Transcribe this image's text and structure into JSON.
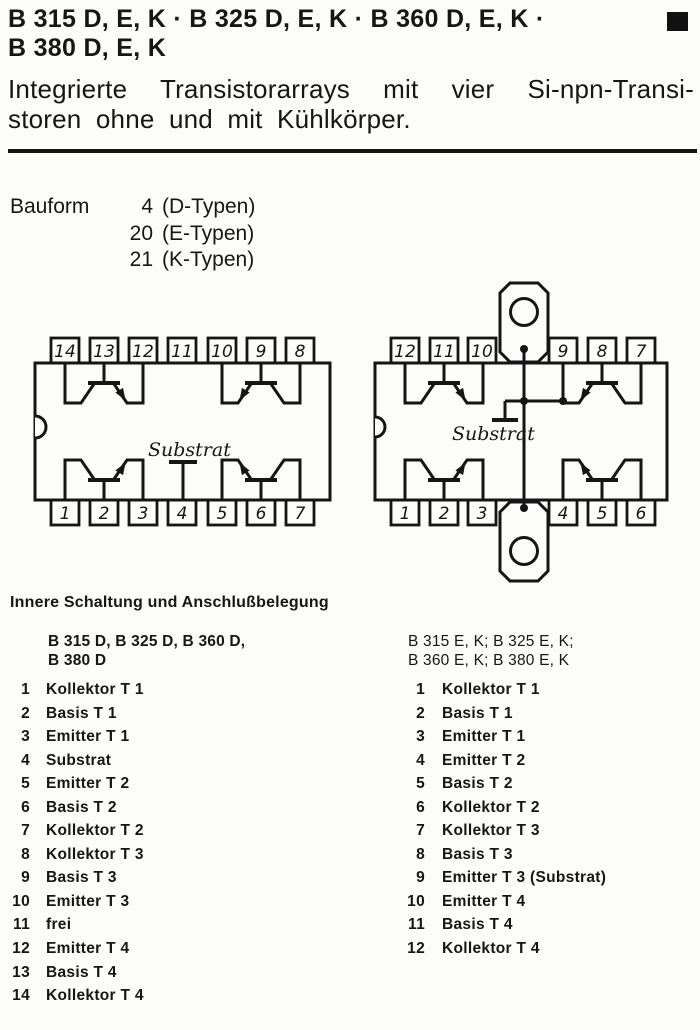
{
  "page": {
    "title_line1": "B 315 D, E, K · B 325 D, E, K · B 360 D, E, K ·",
    "title_line2": "B 380 D, E, K",
    "subtitle_line1": "Integrierte Transistorarrays mit vier Si-npn-Transi-",
    "subtitle_line2": "storen ohne und mit Kühlkörper."
  },
  "bauform": {
    "label": "Bauform",
    "rows": [
      {
        "num": "4",
        "text": "(D-Typen)"
      },
      {
        "num": "20",
        "text": "(E-Typen)"
      },
      {
        "num": "21",
        "text": "(K-Typen)"
      }
    ]
  },
  "diagrams": {
    "left": {
      "top_pins": [
        "14",
        "13",
        "12",
        "11",
        "10",
        "9",
        "8"
      ],
      "bottom_pins": [
        "1",
        "2",
        "3",
        "4",
        "5",
        "6",
        "7"
      ],
      "substrate_label": "Substrat"
    },
    "right": {
      "top_pins": [
        "12",
        "11",
        "10",
        "9",
        "8",
        "7"
      ],
      "bottom_pins": [
        "1",
        "2",
        "3",
        "4",
        "5",
        "6"
      ],
      "substrate_label": "Substrat"
    }
  },
  "section": {
    "heading": "Innere Schaltung und Anschlußbelegung",
    "left_column": {
      "title_line1": "B 315 D, B 325 D, B 360 D,",
      "title_line2": "B 380 D",
      "pins": [
        {
          "n": "1",
          "label": "Kollektor T 1"
        },
        {
          "n": "2",
          "label": "Basis T 1"
        },
        {
          "n": "3",
          "label": "Emitter T 1"
        },
        {
          "n": "4",
          "label": "Substrat"
        },
        {
          "n": "5",
          "label": "Emitter T 2"
        },
        {
          "n": "6",
          "label": "Basis T 2"
        },
        {
          "n": "7",
          "label": "Kollektor T 2"
        },
        {
          "n": "8",
          "label": "Kollektor T 3"
        },
        {
          "n": "9",
          "label": "Basis T 3"
        },
        {
          "n": "10",
          "label": "Emitter T 3"
        },
        {
          "n": "11",
          "label": "frei"
        },
        {
          "n": "12",
          "label": "Emitter T 4"
        },
        {
          "n": "13",
          "label": "Basis T 4"
        },
        {
          "n": "14",
          "label": "Kollektor T 4"
        }
      ]
    },
    "right_column": {
      "title_line1": "B 315 E, K; B 325 E, K;",
      "title_line2": "B 360 E, K; B 380 E, K",
      "pins": [
        {
          "n": "1",
          "label": "Kollektor T 1"
        },
        {
          "n": "2",
          "label": "Basis T 1"
        },
        {
          "n": "3",
          "label": "Emitter T 1"
        },
        {
          "n": "4",
          "label": "Emitter T 2"
        },
        {
          "n": "5",
          "label": "Basis T 2"
        },
        {
          "n": "6",
          "label": "Kollektor T 2"
        },
        {
          "n": "7",
          "label": "Kollektor T 3"
        },
        {
          "n": "8",
          "label": "Basis T 3"
        },
        {
          "n": "9",
          "label": "Emitter T 3 (Substrat)"
        },
        {
          "n": "10",
          "label": "Emitter T 4"
        },
        {
          "n": "11",
          "label": "Basis T 4"
        },
        {
          "n": "12",
          "label": "Kollektor T 4"
        }
      ]
    }
  },
  "colors": {
    "ink": "#161616",
    "paper": "#fcfcfa"
  }
}
